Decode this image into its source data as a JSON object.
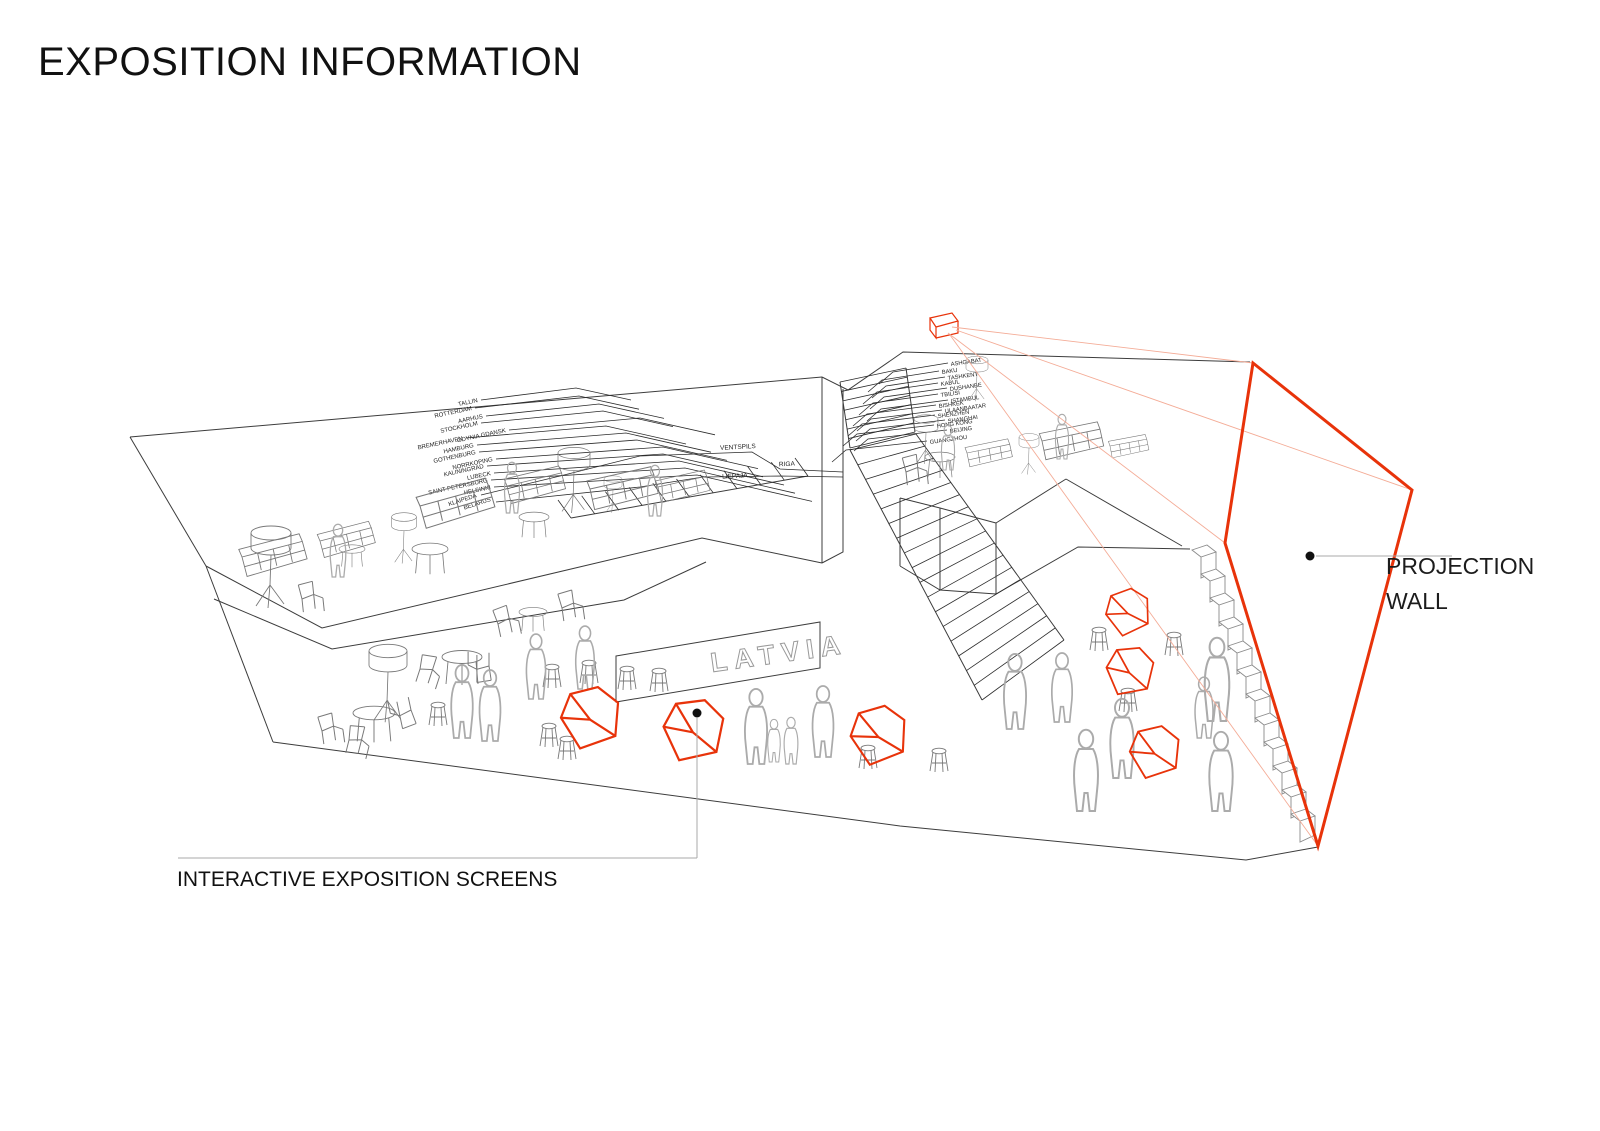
{
  "title": "EXPOSITION INFORMATION",
  "labels": {
    "projection_wall": [
      "PROJECTION",
      "WALL"
    ],
    "interactive_screens": "INTERACTIVE EXPOSITION SCREENS",
    "latvia_sign": "LATVIA"
  },
  "cities_left": [
    "TALLIN",
    "ROTTERDAM",
    "AARHUS",
    "STOCKHOLM",
    "GDYNIA GDANSK",
    "BREMERHAVEN",
    "HAMBURG",
    "GOTHENBURG",
    "NORRKOPING",
    "KALININGRAD",
    "LUBECK",
    "SAINT PETERSBURG",
    "HELSINKI",
    "KLAIPEDA",
    "BELARUS"
  ],
  "route_ports": [
    "VENTSPILS",
    "RIGA",
    "LIEPAJA"
  ],
  "cities_right": [
    "ASHGABAT",
    "BAKU",
    "TASHKENT",
    "KABUL",
    "DUSHANBE",
    "TBILISI",
    "ISTAMBUL",
    "BISHKEK",
    "ULAANBAATAR",
    "SHENZHEN",
    "SHANGHAI",
    "HONG KONG",
    "BEIJING",
    "GUANGZHOU"
  ],
  "colors": {
    "highlight": "#e8330a",
    "projection_fan": "#f4ac97",
    "architecture": "#3c3c3c",
    "furniture": "#787878",
    "people": "#ababab"
  }
}
